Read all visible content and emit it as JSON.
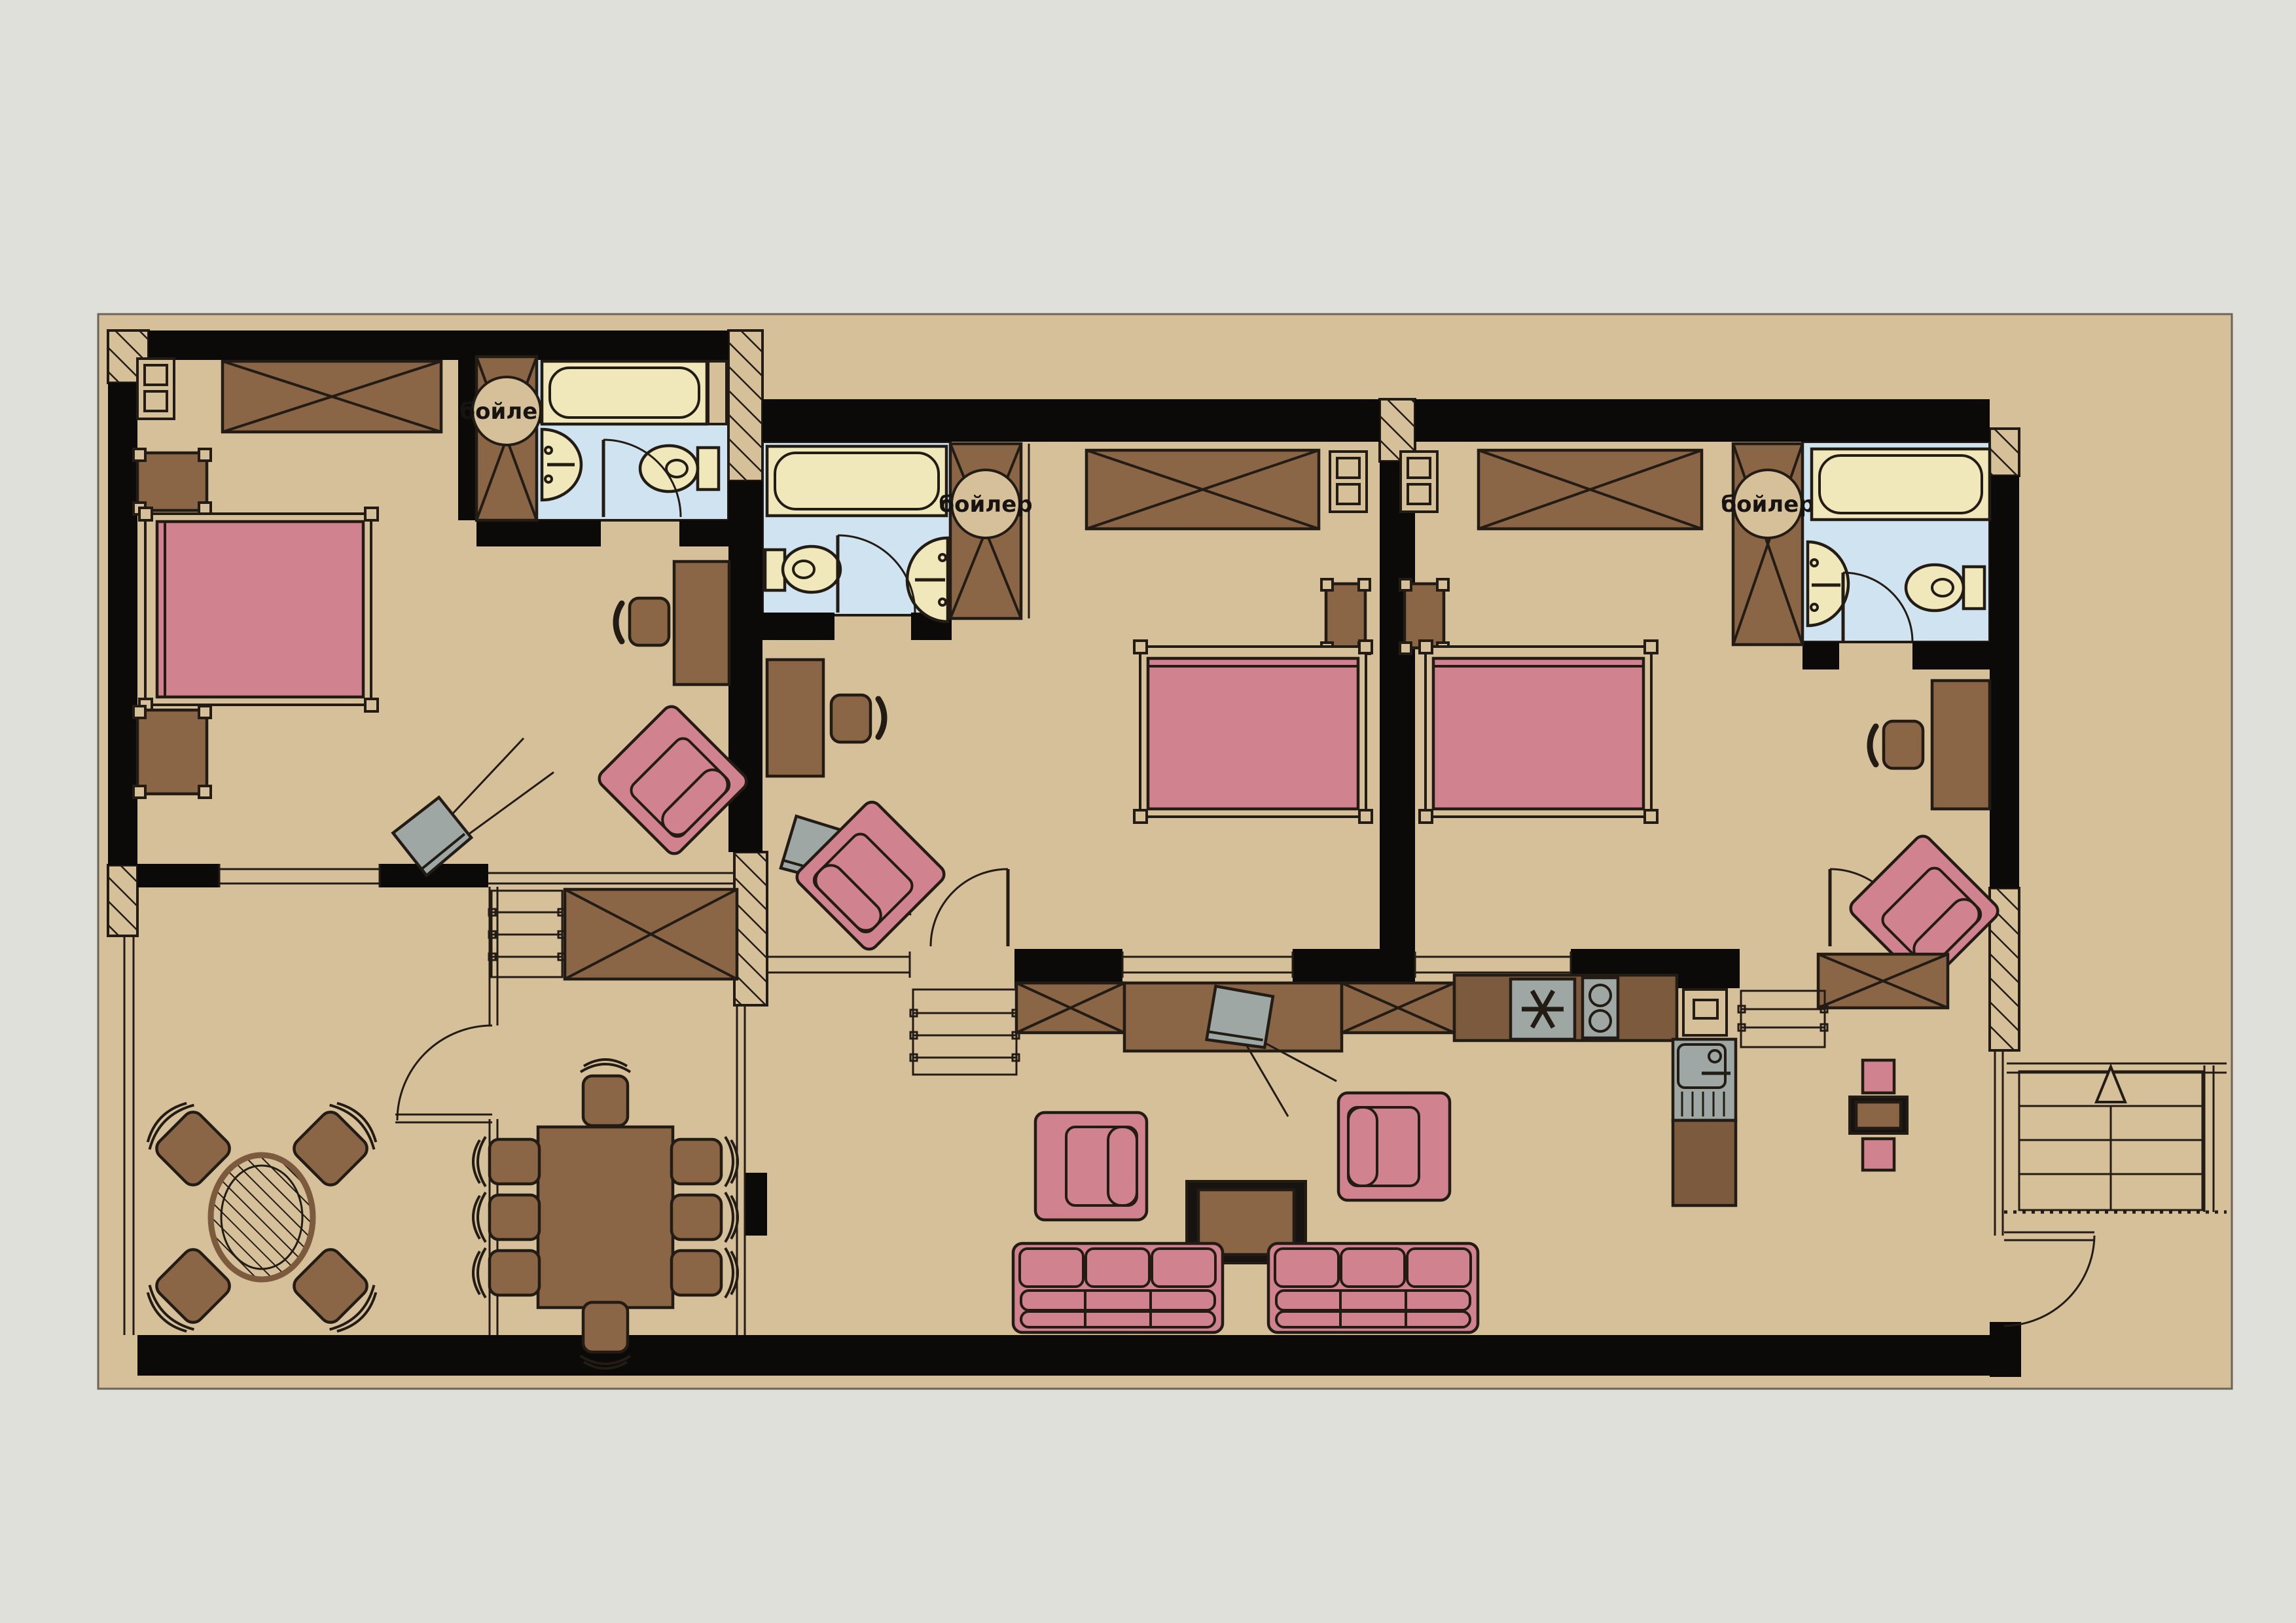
{
  "labels": {
    "boilers": [
      "бойлер",
      "бойлер",
      "бойлер"
    ]
  },
  "palette": {
    "background": "#dfe0d9",
    "floor": "#d5c09a",
    "wall": "#0b0a08",
    "outline": "#221c15",
    "brown": "#8a6546",
    "brown_dark": "#7c5a3e",
    "brown_light": "#96714e",
    "pink": "#d0838f",
    "cream": "#f0e8ba",
    "blue": "#cfe4f0",
    "gray": "#9fa7a5",
    "ink": "#171310"
  }
}
